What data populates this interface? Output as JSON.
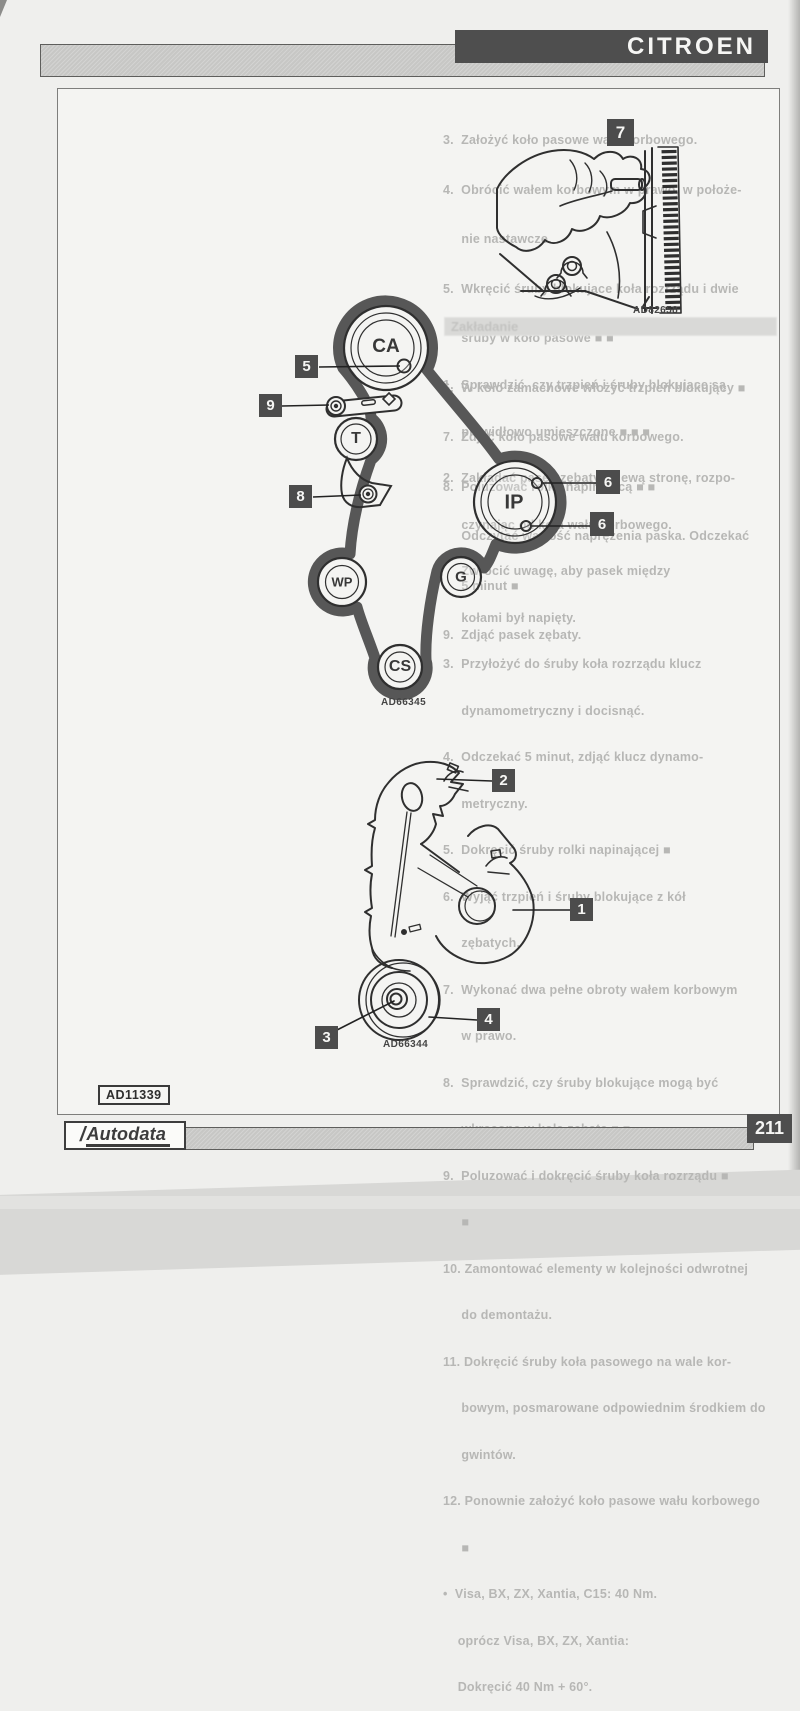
{
  "colors": {
    "accent_dark": "#4e4e4e",
    "bar_gray": "#c7c7c5",
    "paper": "#f4f4f2",
    "belt": "#575757",
    "ghost_text": "#b7b7b5"
  },
  "header": {
    "brand": "CITROEN"
  },
  "footer": {
    "logo_slash": "/",
    "logo": "Autodata",
    "page_number": "211"
  },
  "stamp": {
    "figure_ref": "AD11339"
  },
  "fig_flywheel": {
    "number": "7",
    "caption": "AD82658"
  },
  "fig_belt": {
    "caption": "AD66345",
    "labels": {
      "ca": "CA",
      "t": "T",
      "ip": "IP",
      "wp": "WP",
      "g": "G",
      "cs": "CS"
    },
    "callouts": {
      "c5": "5",
      "c9": "9",
      "c8": "8",
      "c6a": "6",
      "c6b": "6"
    }
  },
  "fig_cover": {
    "caption": "AD66344",
    "callouts": {
      "c1": "1",
      "c2": "2",
      "c3": "3",
      "c4": "4"
    }
  },
  "ghost": {
    "heading": "Zakładanie",
    "top": [
      "3.  Założyć koło pasowe wału korbowego.",
      "4.  Obrócić wałem korbowym w prawo, w położe-",
      "     nie nastawcze.",
      "5.  Wkręcić śruby blokujące koła rozrządu i dwie",
      "     śruby w koło pasowe ■ ■",
      "6.  W koło zamachowe włożyć trzpień blokujący ■",
      "7.  Zdjąć koło pasowe wału korbowego.",
      "8.  Poluzować rolkę napinającą ■ ■",
      "     Odczytać wartość naprężenia paska. Odczekać",
      "     5 minut ■",
      "9.  Zdjąć pasek zębaty."
    ],
    "main": [
      "1.  Sprawdzić, czy trzpień i śruby blokujące są",
      "     prawidłowo umieszczone ■ ■ ■",
      "2.  Zakładać pasek zębaty w lewą stronę, rozpo-",
      "     czynając od koła wału korbowego.",
      "     Zwrócić uwagę, aby pasek między",
      "     kołami był napięty.",
      "3.  Przyłożyć do śruby koła rozrządu klucz",
      "     dynamometryczny i docisnąć.",
      "4.  Odczekać 5 minut, zdjąć klucz dynamo-",
      "     metryczny.",
      "5.  Dokręcić śruby rolki napinającej ■",
      "6.  Wyjąć trzpień i śruby blokujące z kół",
      "     zębatych.",
      "7.  Wykonać dwa pełne obroty wałem korbowym",
      "     w prawo.",
      "8.  Sprawdzić, czy śruby blokujące mogą być",
      "     wkręcone w koła zębate ■ ■",
      "9.  Poluzować i dokręcić śruby koła rozrządu ■",
      "     ■",
      "10. Zamontować elementy w kolejności odwrotnej",
      "     do demontażu.",
      "11. Dokręcić śruby koła pasowego na wale kor-",
      "     bowym, posmarowane odpowiednim środkiem do",
      "     gwintów.",
      "12. Ponownie założyć koło pasowe wału korbowego",
      "     ■",
      "•  Visa, BX, ZX, Xantia, C15: 40 Nm.",
      "    oprócz Visa, BX, ZX, Xantia:",
      "    Dokręcić 40 Nm + 60°."
    ]
  }
}
